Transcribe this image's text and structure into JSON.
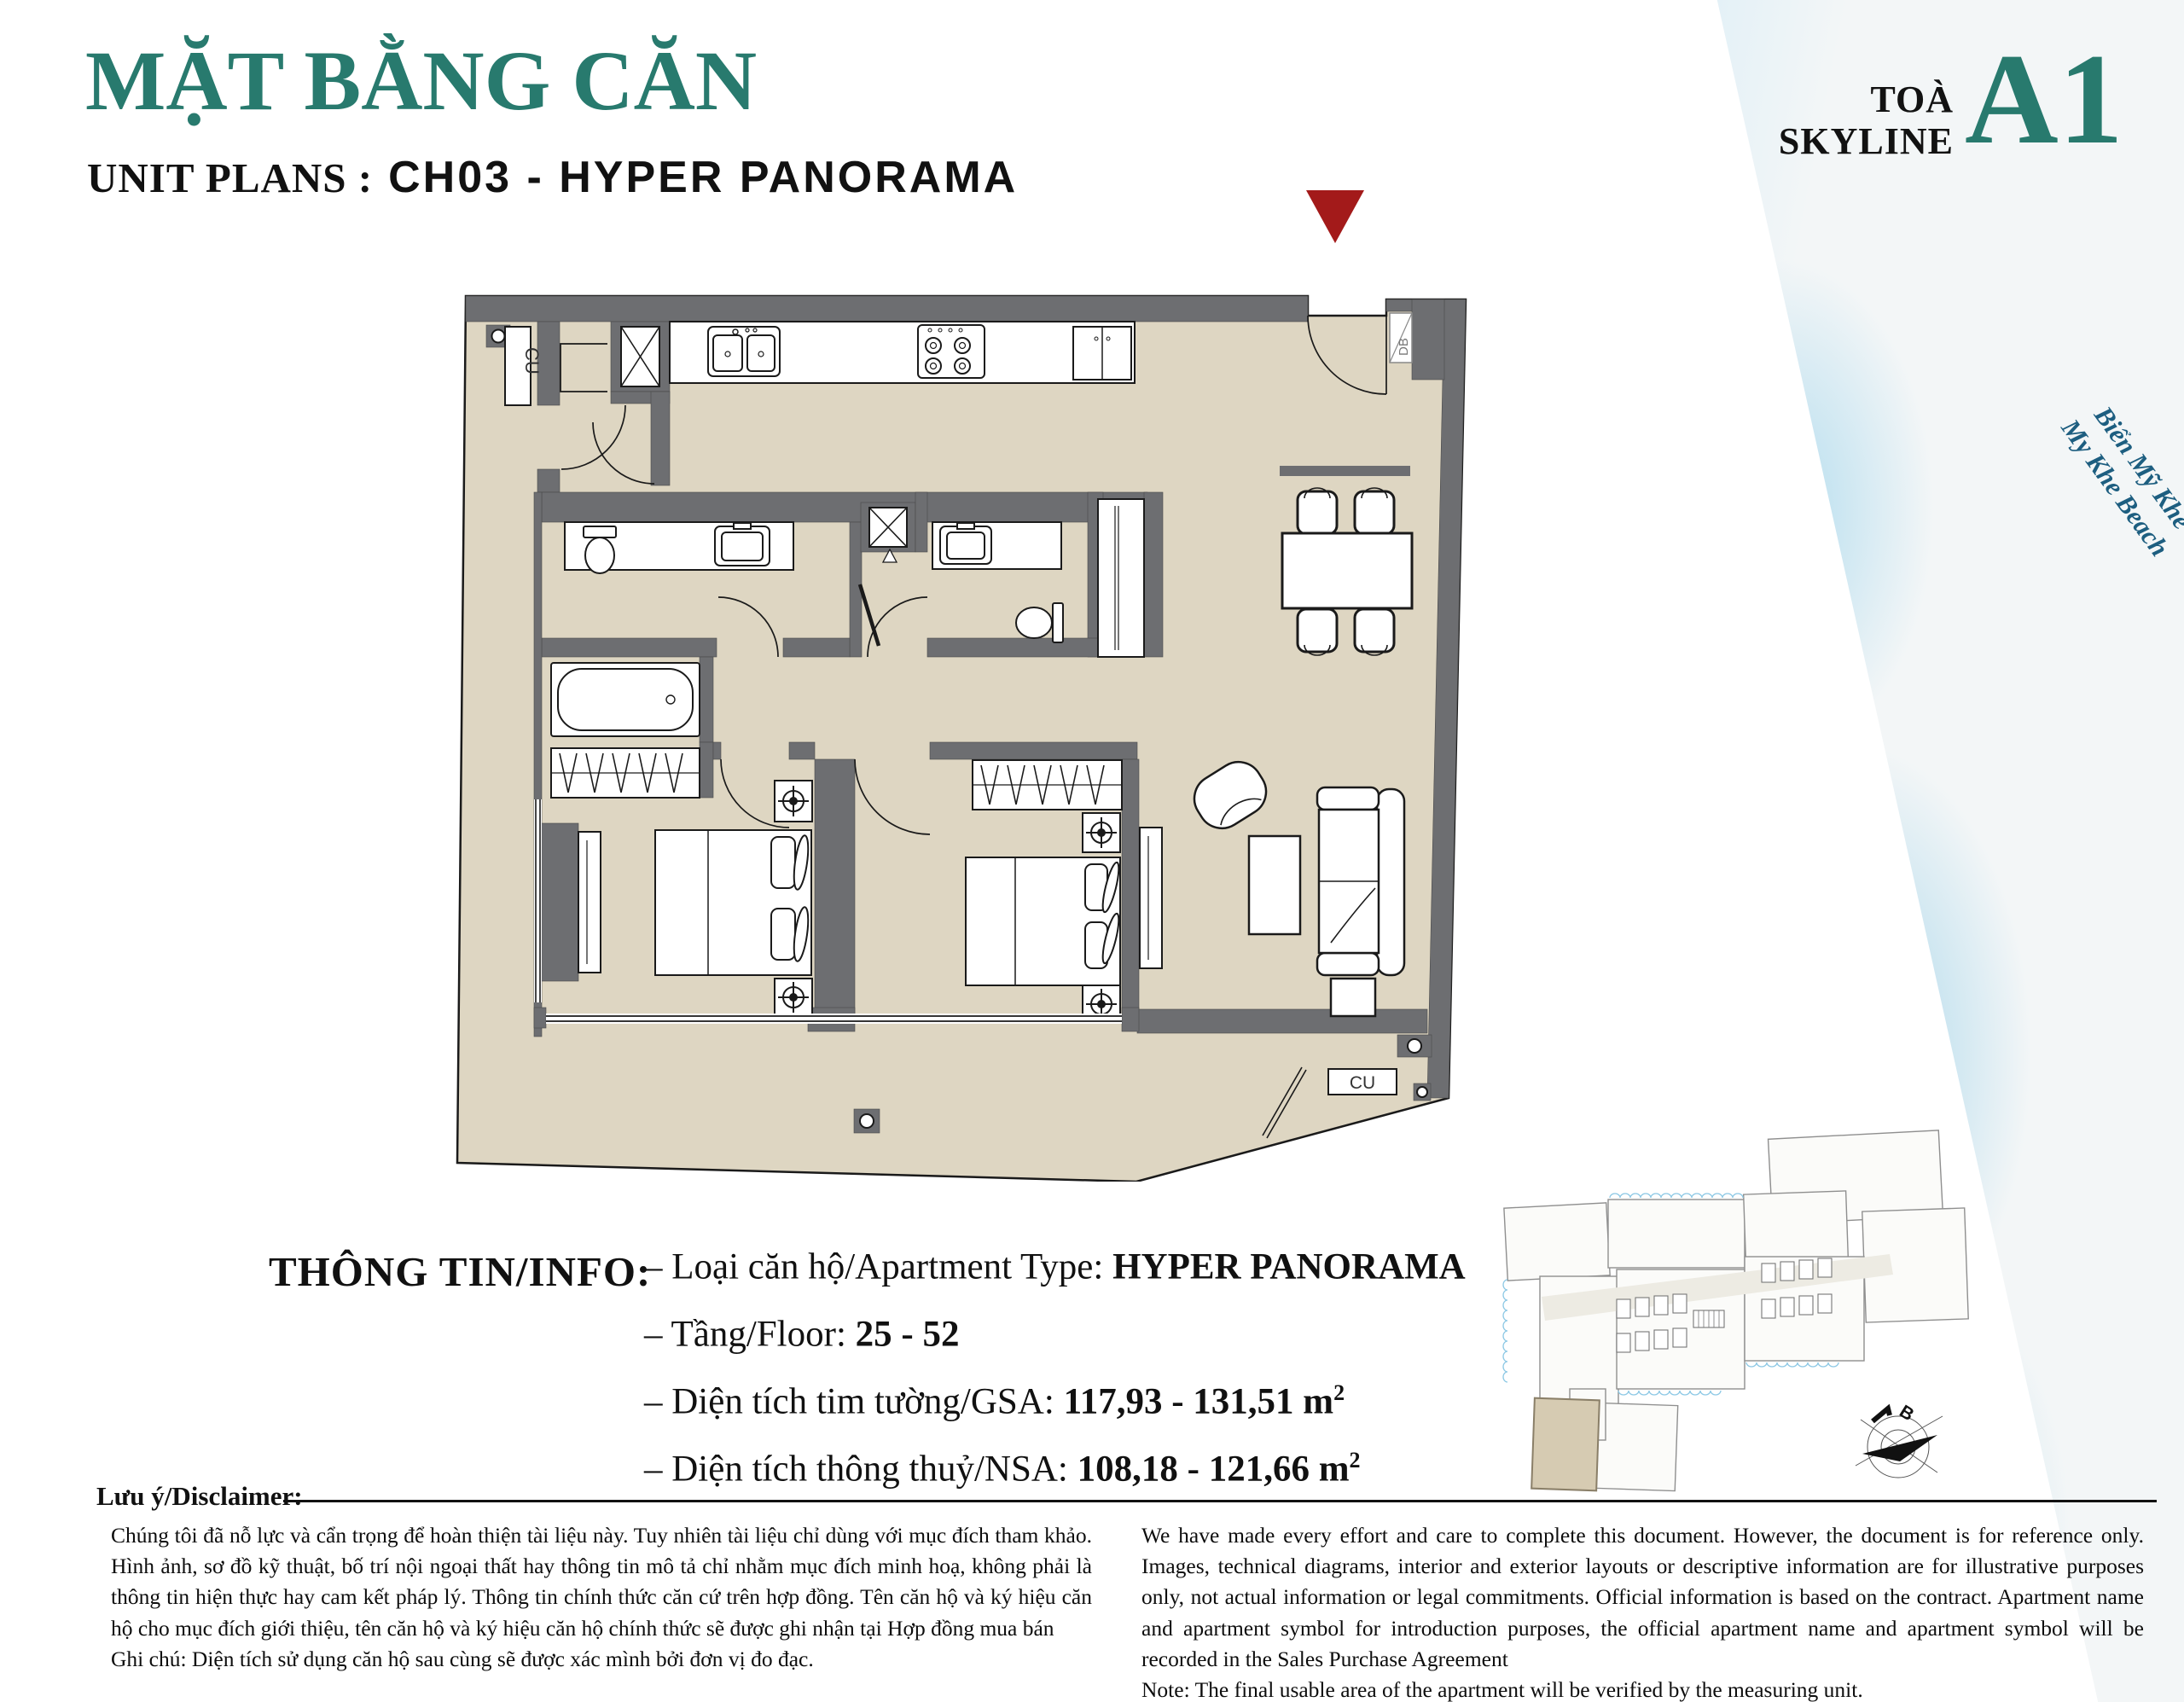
{
  "header": {
    "title": "MẶT BẰNG CĂN",
    "title_color": "#287a6e",
    "unit_label": "UNIT PLANS :",
    "unit_value": "CH03 - HYPER PANORAMA",
    "tower_line1": "TOÀ",
    "tower_line2": "SKYLINE",
    "tower_code": "A1",
    "beach_line1": "Biển Mỹ Khê",
    "beach_line2": "My Khe Beach"
  },
  "floor_plan": {
    "entrance_marker_color": "#a31a1a",
    "wall_color": "#6d6e71",
    "floor_color": "#ded6c2",
    "labels": {
      "cu_top": "CU",
      "cu_bottom": "CU",
      "db": "DB"
    }
  },
  "key_plan": {
    "compass_label": "B",
    "highlight_color": "#d6cbb2"
  },
  "info": {
    "heading": "THÔNG TIN/INFO:",
    "rows": [
      {
        "label": "– Loại căn hộ/Apartment Type: ",
        "value": "HYPER PANORAMA",
        "sup": ""
      },
      {
        "label": "– Tầng/Floor: ",
        "value": "25 - 52",
        "sup": ""
      },
      {
        "label": "– Diện tích tim tường/GSA: ",
        "value": "117,93 - 131,51 m",
        "sup": "2"
      },
      {
        "label": "– Diện tích thông thuỷ/NSA: ",
        "value": "108,18 - 121,66 m",
        "sup": "2"
      }
    ]
  },
  "disclaimer": {
    "heading": "Lưu ý/Disclaimer:",
    "vi": "Chúng tôi đã nỗ lực và cẩn trọng để hoàn thiện tài liệu này. Tuy nhiên tài liệu chỉ dùng với mục đích tham khảo. Hình ảnh, sơ đồ kỹ thuật, bố trí nội ngoại thất hay thông tin mô tả chỉ nhằm mục đích minh hoạ, không phải là thông tin hiện thực hay cam kết pháp lý. Thông tin chính thức căn cứ trên hợp đồng. Tên căn hộ và ký hiệu căn hộ cho mục đích giới thiệu, tên căn hộ và ký hiệu căn hộ chính thức sẽ được ghi nhận tại Hợp đồng mua bán",
    "vi_note": "Ghi chú: Diện tích sử dụng căn hộ sau cùng sẽ được xác mình bởi đơn vị đo đạc.",
    "en": "We have made every effort and care to complete this document. However, the document is for reference only. Images, technical diagrams, interior and exterior layouts or descriptive information are for illustrative purposes only, not actual information or legal commitments. Official information is based on the contract. Apartment name and apartment symbol for introduction purposes, the official apartment name and apartment symbol will be recorded in the Sales Purchase Agreement",
    "en_note": "Note: The final usable area of the apartment will be verified by the measuring unit."
  }
}
